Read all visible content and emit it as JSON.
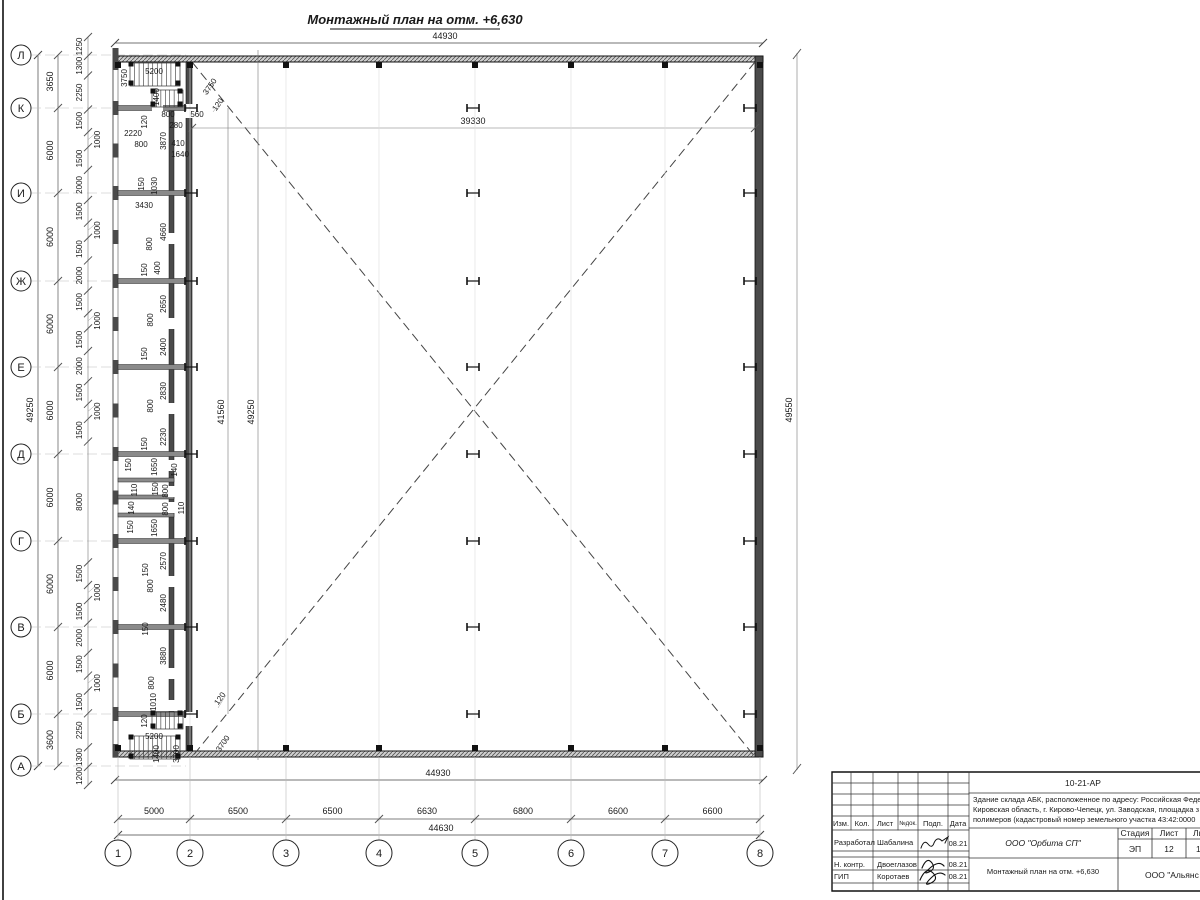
{
  "drawing": {
    "title": "Монтажный план на отм. +6,630",
    "row_axes": [
      "Л",
      "К",
      "И",
      "Ж",
      "Е",
      "Д",
      "Г",
      "В",
      "Б",
      "А"
    ],
    "row_y": [
      55,
      108,
      193,
      281,
      367,
      454,
      541,
      627,
      714,
      766
    ],
    "row_spacings": [
      "3650",
      "6000",
      "6000",
      "6000",
      "6000",
      "6000",
      "6000",
      "6000",
      "3600"
    ],
    "col_axes": [
      "1",
      "2",
      "3",
      "4",
      "5",
      "6",
      "7",
      "8"
    ],
    "col_x": [
      118,
      190,
      286,
      379,
      475,
      571,
      665,
      760
    ],
    "col_spacings": [
      "5000",
      "6500",
      "6500",
      "6630",
      "6800",
      "6600",
      "6600"
    ],
    "totals": {
      "top": "44930",
      "bottom_building": "44930",
      "bottom": "44630",
      "left": "49250",
      "right": "49550"
    },
    "inner_dims": {
      "hall_width": "39330",
      "hall_h1": "41560",
      "hall_h2": "49250"
    },
    "left_chain": [
      "1250",
      "1300",
      "2250",
      "1500",
      "1000",
      "1500",
      "2000",
      "1500",
      "1000",
      "1500",
      "2000",
      "1500",
      "1000",
      "1500",
      "2000",
      "1500",
      "1000",
      "1500",
      "8000",
      "1500",
      "1000",
      "1500",
      "2000",
      "1500",
      "1000",
      "1500",
      "2250",
      "1300",
      "1200"
    ],
    "annotations": [
      {
        "t": "3750",
        "x": 127,
        "y": 78,
        "r": -90
      },
      {
        "t": "5200",
        "x": 154,
        "y": 74,
        "r": 0
      },
      {
        "t": "1400",
        "x": 159,
        "y": 97,
        "r": -90
      },
      {
        "t": "120",
        "x": 147,
        "y": 122,
        "r": -90
      },
      {
        "t": "800",
        "x": 168,
        "y": 117,
        "r": 0
      },
      {
        "t": "280",
        "x": 176,
        "y": 128,
        "r": 0
      },
      {
        "t": "560",
        "x": 197,
        "y": 117,
        "r": 0
      },
      {
        "t": "2220",
        "x": 133,
        "y": 136,
        "r": 0
      },
      {
        "t": "800",
        "x": 141,
        "y": 147,
        "r": 0
      },
      {
        "t": "3870",
        "x": 166,
        "y": 141,
        "r": -90
      },
      {
        "t": "410",
        "x": 178,
        "y": 146,
        "r": 0
      },
      {
        "t": "1640",
        "x": 180,
        "y": 157,
        "r": 0
      },
      {
        "t": "3750",
        "x": 212,
        "y": 88,
        "r": -55
      },
      {
        "t": "120",
        "x": 220,
        "y": 106,
        "r": -55
      },
      {
        "t": "150",
        "x": 144,
        "y": 184,
        "r": -90
      },
      {
        "t": "1030",
        "x": 157,
        "y": 186,
        "r": -90
      },
      {
        "t": "3430",
        "x": 144,
        "y": 208,
        "r": 0
      },
      {
        "t": "4660",
        "x": 166,
        "y": 232,
        "r": -90
      },
      {
        "t": "800",
        "x": 152,
        "y": 244,
        "r": -90
      },
      {
        "t": "150",
        "x": 147,
        "y": 270,
        "r": -90
      },
      {
        "t": "400",
        "x": 160,
        "y": 268,
        "r": -90
      },
      {
        "t": "2650",
        "x": 166,
        "y": 304,
        "r": -90
      },
      {
        "t": "800",
        "x": 153,
        "y": 320,
        "r": -90
      },
      {
        "t": "2400",
        "x": 166,
        "y": 347,
        "r": -90
      },
      {
        "t": "150",
        "x": 147,
        "y": 354,
        "r": -90
      },
      {
        "t": "2830",
        "x": 166,
        "y": 391,
        "r": -90
      },
      {
        "t": "800",
        "x": 153,
        "y": 406,
        "r": -90
      },
      {
        "t": "2230",
        "x": 166,
        "y": 437,
        "r": -90
      },
      {
        "t": "150",
        "x": 147,
        "y": 444,
        "r": -90
      },
      {
        "t": "1650",
        "x": 157,
        "y": 467,
        "r": -90
      },
      {
        "t": "150",
        "x": 131,
        "y": 465,
        "r": -90
      },
      {
        "t": "140",
        "x": 177,
        "y": 470,
        "r": -90
      },
      {
        "t": "110",
        "x": 137,
        "y": 490,
        "r": -90
      },
      {
        "t": "150",
        "x": 158,
        "y": 489,
        "r": -90
      },
      {
        "t": "800",
        "x": 168,
        "y": 491,
        "r": -90
      },
      {
        "t": "140",
        "x": 134,
        "y": 508,
        "r": -90
      },
      {
        "t": "800",
        "x": 168,
        "y": 509,
        "r": -90
      },
      {
        "t": "110",
        "x": 184,
        "y": 508,
        "r": -90
      },
      {
        "t": "1650",
        "x": 157,
        "y": 528,
        "r": -90
      },
      {
        "t": "150",
        "x": 133,
        "y": 527,
        "r": -90
      },
      {
        "t": "2570",
        "x": 166,
        "y": 561,
        "r": -90
      },
      {
        "t": "150",
        "x": 148,
        "y": 570,
        "r": -90
      },
      {
        "t": "800",
        "x": 153,
        "y": 586,
        "r": -90
      },
      {
        "t": "2480",
        "x": 166,
        "y": 603,
        "r": -90
      },
      {
        "t": "150",
        "x": 148,
        "y": 629,
        "r": -90
      },
      {
        "t": "3880",
        "x": 166,
        "y": 656,
        "r": -90
      },
      {
        "t": "800",
        "x": 154,
        "y": 683,
        "r": -90
      },
      {
        "t": "1010",
        "x": 156,
        "y": 702,
        "r": -90
      },
      {
        "t": "120",
        "x": 147,
        "y": 721,
        "r": -90
      },
      {
        "t": "5200",
        "x": 154,
        "y": 739,
        "r": 0
      },
      {
        "t": "1400",
        "x": 159,
        "y": 754,
        "r": -90
      },
      {
        "t": "3700",
        "x": 179,
        "y": 754,
        "r": -90
      },
      {
        "t": "3700",
        "x": 225,
        "y": 745,
        "r": -55
      },
      {
        "t": "120",
        "x": 222,
        "y": 700,
        "r": -55
      }
    ]
  },
  "titleblock": {
    "code": "10-21-АР",
    "desc1": "Здание склада АБК, расположенное по адресу: Российская Феде",
    "desc2": "Кировская область, г. Кирово-Чепецк, ул. Заводская, площадка з",
    "desc3": "полимеров (кадастровый номер земельного участка 43:42:0000",
    "cols": {
      "izm": "Изм.",
      "kol": "Кол.",
      "list": "Лист",
      "ndok": "№док.",
      "podp": "Подп.",
      "data": "Дата"
    },
    "rows": [
      {
        "role": "Разработал",
        "name": "Шабалина",
        "date": "08.21"
      },
      {
        "role": "Н. контр.",
        "name": "Двоеглазов",
        "date": "08.21"
      },
      {
        "role": "ГИП",
        "name": "Коротаев",
        "date": "08.21"
      }
    ],
    "org": "ООО \"Орбита СП\"",
    "subject": "Монтажный план на отм. +6,630",
    "stage_label": "Стадия",
    "sheet_label": "Лист",
    "sheets_label": "Листов",
    "stage": "ЭП",
    "sheet_no": "12",
    "sheets_no": "1",
    "contractor": "ООО \"Альянс"
  }
}
